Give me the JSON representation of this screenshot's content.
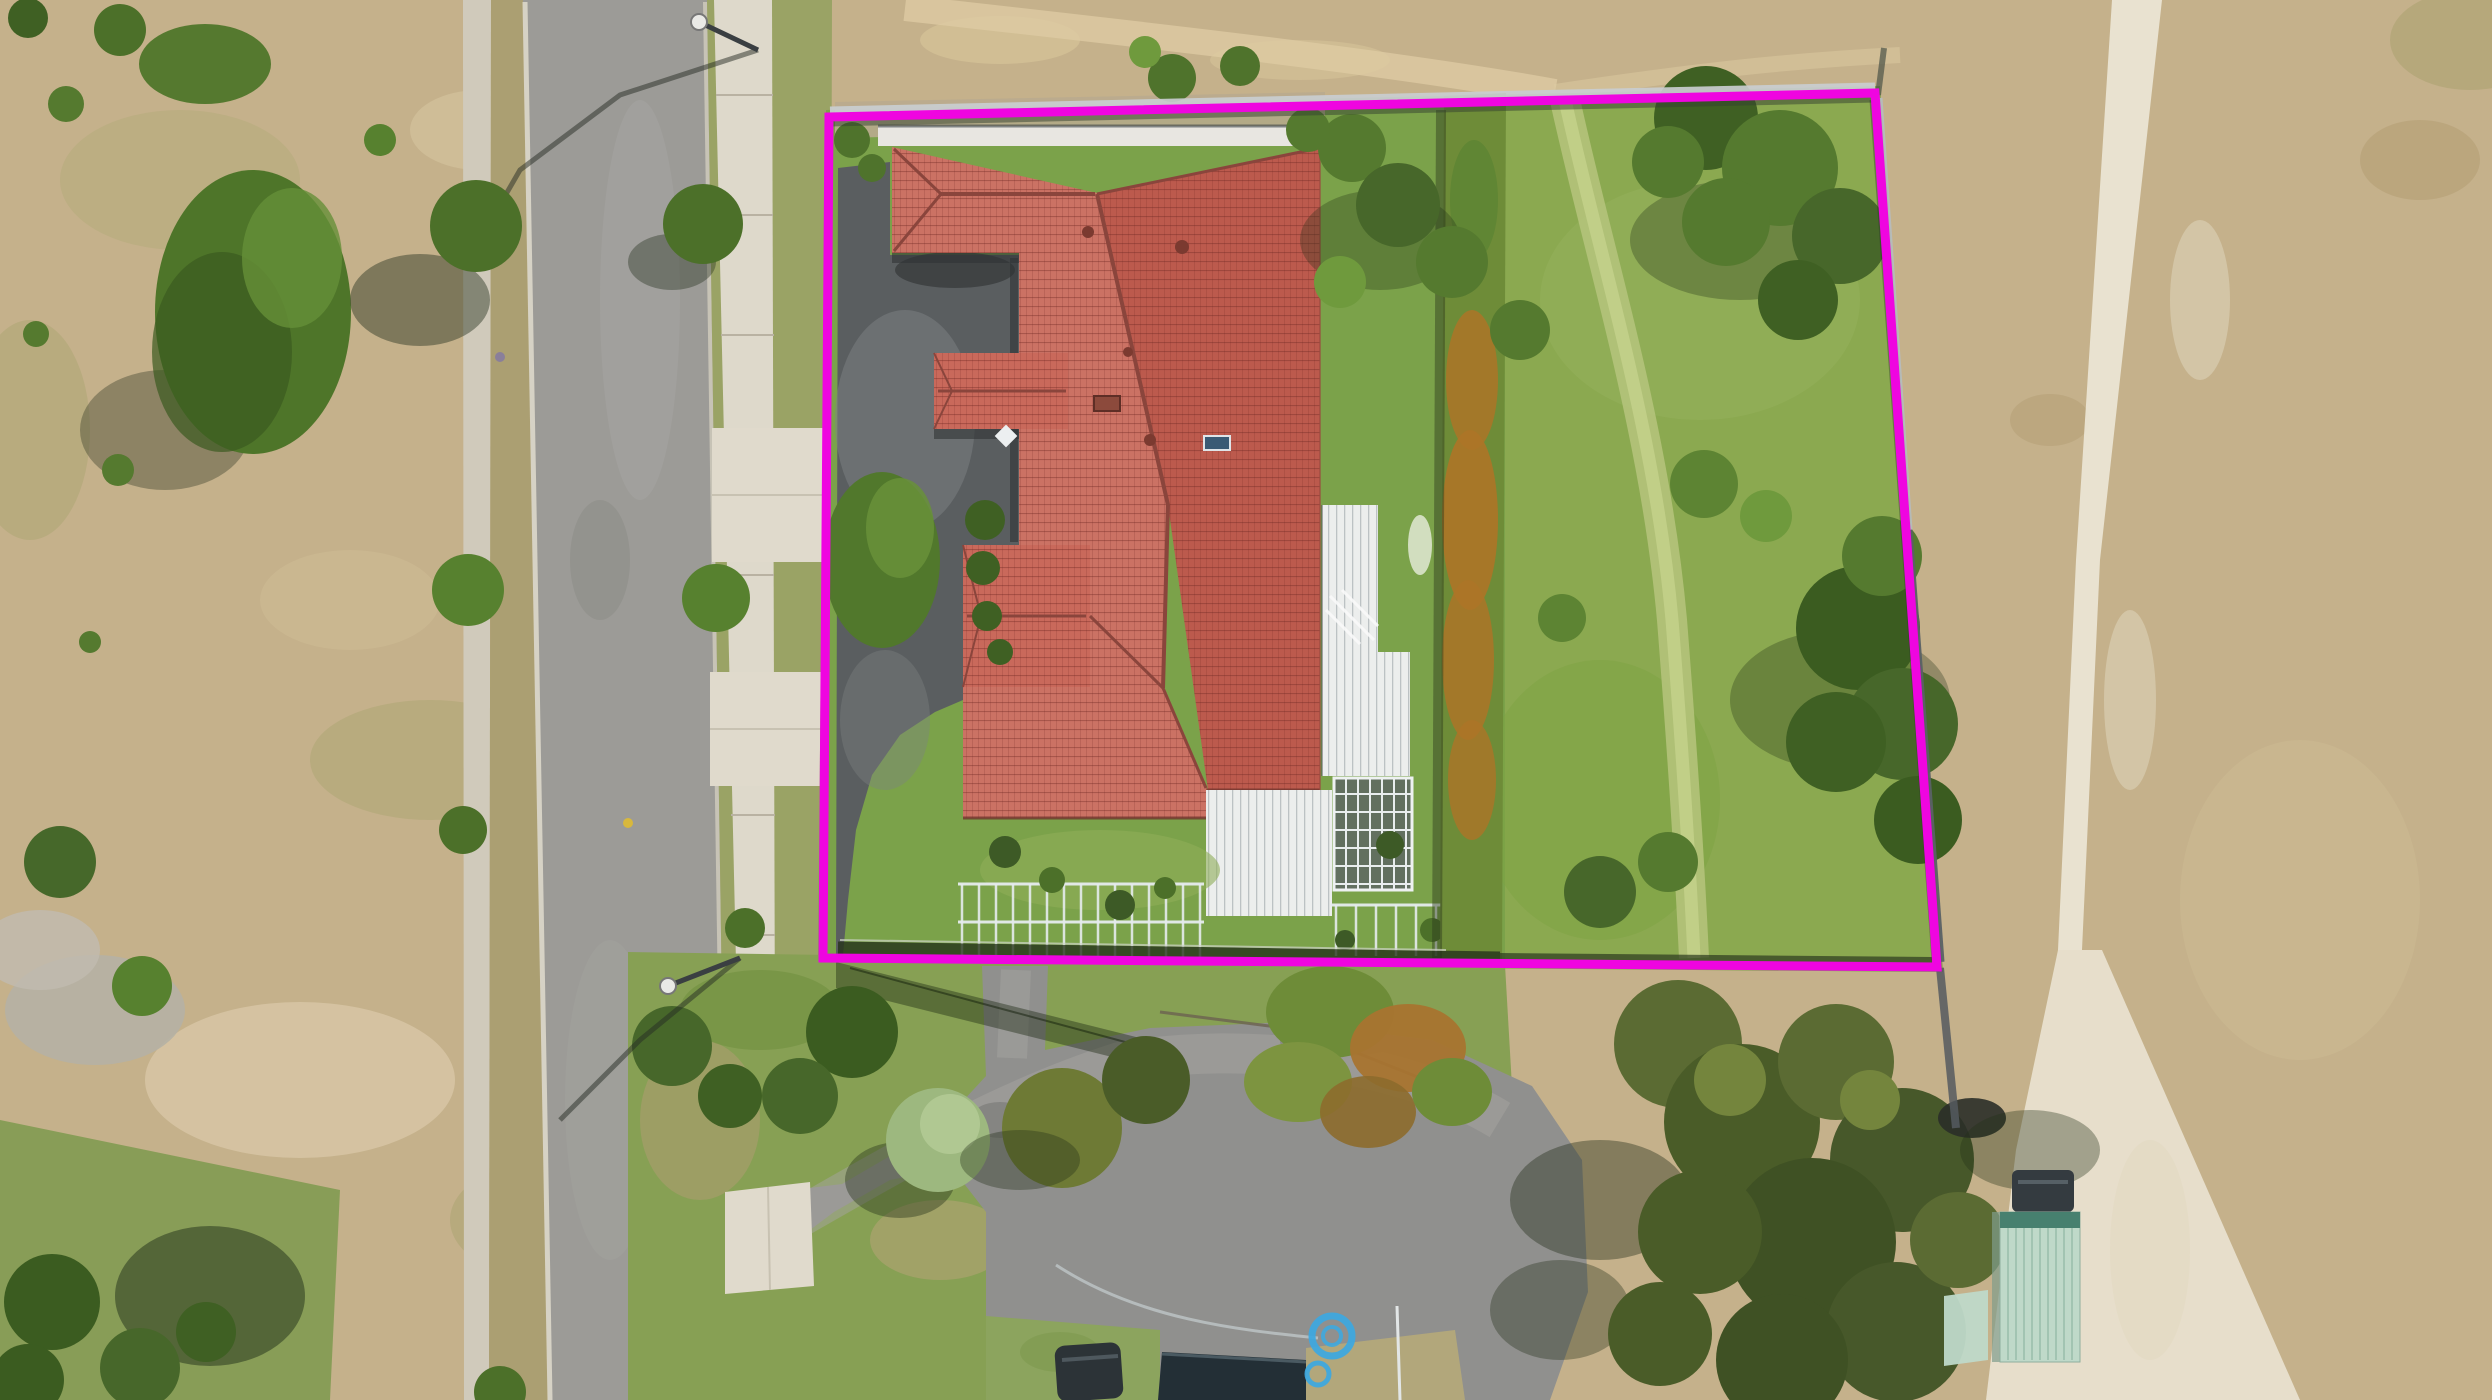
{
  "image": {
    "width": 2492,
    "height": 1400,
    "kind": "aerial-drone-photo"
  },
  "overlay": {
    "boundary": {
      "points": "829,117 1875,93 1937,967 823,958",
      "color": "#ef05e0",
      "stroke_width": 9
    }
  },
  "palette": {
    "field": "#c5b18b",
    "field_light": "#d9c8a6",
    "white_track": "#ece6d6",
    "road": "#9c9b97",
    "curb": "#ddd8ca",
    "footpath": "#d0cabb",
    "sidewalk": "#ded9cb",
    "concrete_pad": "#e0dacc",
    "verge": "#9aa365",
    "lawn": "#7ba24a",
    "lawn_east": "#8caa50",
    "worn_path": "#b6c47c",
    "courtyard": "#5a5e60",
    "roof_west": "#cb7264",
    "roof_east": "#bc5a4d",
    "roof_gable": "#c9695b",
    "ridge": "#8a453c",
    "white_roof": "#eceeed",
    "conservatory": "#62705f",
    "hedge": "#6e8c38",
    "hedge_orange": "#ad7427",
    "tree_dark": "#3f6023",
    "tree_mid": "#557a2f",
    "tree_light": "#6f9a3d",
    "tree_olive": "#5b6b33",
    "tree_sage": "#9db87f",
    "shed": "#bfd9c9",
    "shed_roof_edge": "#47806f",
    "hose": "#3fa8de",
    "fence_light": "#c9cdd0",
    "fence_dark": "#5a6165",
    "shadow": "#1f2e14"
  },
  "features": [
    "magenta-property-boundary-outline",
    "red-tile-hip-roof-house",
    "asphalt-courtyard-driveway",
    "white-veranda-roofs",
    "glass-conservatory",
    "backyard-lawn-with-worn-path",
    "tall-garden-hedge",
    "residential-street-with-footpaths",
    "concrete-driveway-crossings",
    "street-lights",
    "dry-grass-paddocks",
    "white-dirt-track",
    "curved-rear-driveway",
    "garden-shed",
    "parked-cars",
    "blue-garden-hose-coils",
    "trees-and-shrubs"
  ]
}
